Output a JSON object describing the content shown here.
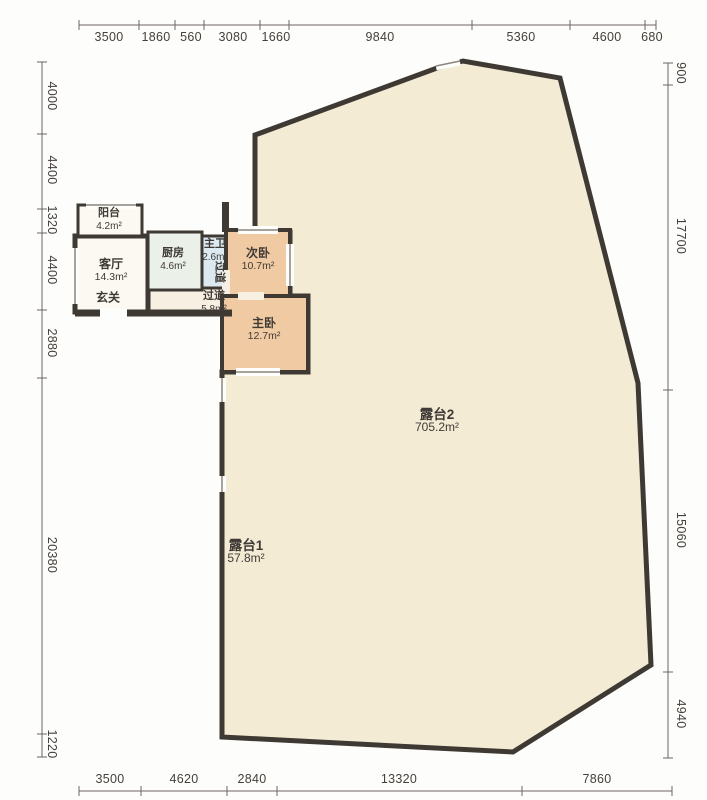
{
  "title": "residential floor plan with terraces",
  "dimensions": {
    "top": [
      "3500",
      "1860",
      "560",
      "3080",
      "1660",
      "9840",
      "5360",
      "4600",
      "680"
    ],
    "left": [
      "4000",
      "4400",
      "1320",
      "4400",
      "2880",
      "20380",
      "1220"
    ],
    "right": [
      "900",
      "17700",
      "15060",
      "4940"
    ],
    "bottom": [
      "3500",
      "4620",
      "2840",
      "13320",
      "7860"
    ]
  },
  "rooms": {
    "balcony": {
      "name": "阳台",
      "area": "4.2m²"
    },
    "living": {
      "name": "客厅",
      "area": "14.3m²"
    },
    "foyer": {
      "name": "玄关"
    },
    "kitchen": {
      "name": "厨房",
      "area": "4.6m²"
    },
    "master_bath": {
      "name": "主卫",
      "area": "2.6m²"
    },
    "hallway": {
      "name": "过道",
      "area": "5.8m²"
    },
    "bedroom2": {
      "name": "次卧",
      "area": "10.7m²"
    },
    "master_bedroom": {
      "name": "主卧",
      "area": "12.7m²"
    },
    "terrace1": {
      "name": "露台1",
      "area": "57.8m²"
    },
    "terrace2": {
      "name": "露台2",
      "area": "705.2m²"
    }
  },
  "colors": {
    "wall": "#3e3933",
    "terrace_fill": "#f4ebd5",
    "bedroom_fill": "#f0caa2",
    "kitchen_fill": "#ebf0e8",
    "bath_fill": "#dce9f0",
    "living_fill": "#fcf9f2",
    "hallway_fill": "#f6efe2",
    "dimension_text": "#45403b"
  }
}
